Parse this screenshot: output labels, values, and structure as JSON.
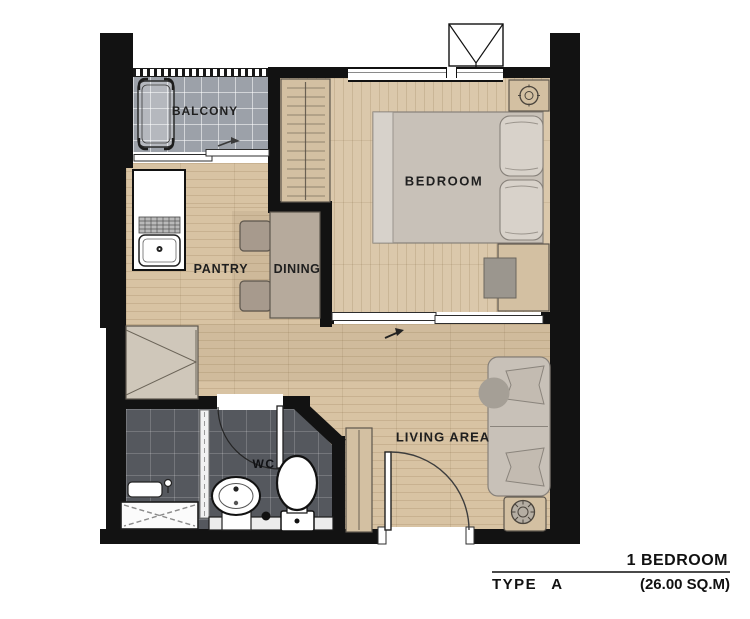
{
  "rooms": {
    "balcony": "BALCONY",
    "bedroom": "BEDROOM",
    "pantry": "PANTRY",
    "dining": "DINING",
    "living": "LIVING AREA",
    "wc": "WC"
  },
  "title": {
    "line1": "1 BEDROOM",
    "type": "TYPE A",
    "area": "(26.00 SQ.M)"
  },
  "colors": {
    "wall": "#121212",
    "floor": "#d8c3a3",
    "bedroom_floor": "#dbc8ab",
    "balcony_tile": "#9ca1a9",
    "bath_tile": "#55585e",
    "furniture_fill": "#d3c0a2",
    "furniture_stroke": "#5d564d",
    "soft_gray": "#c8c1b8",
    "text": "#1f1f1f"
  }
}
